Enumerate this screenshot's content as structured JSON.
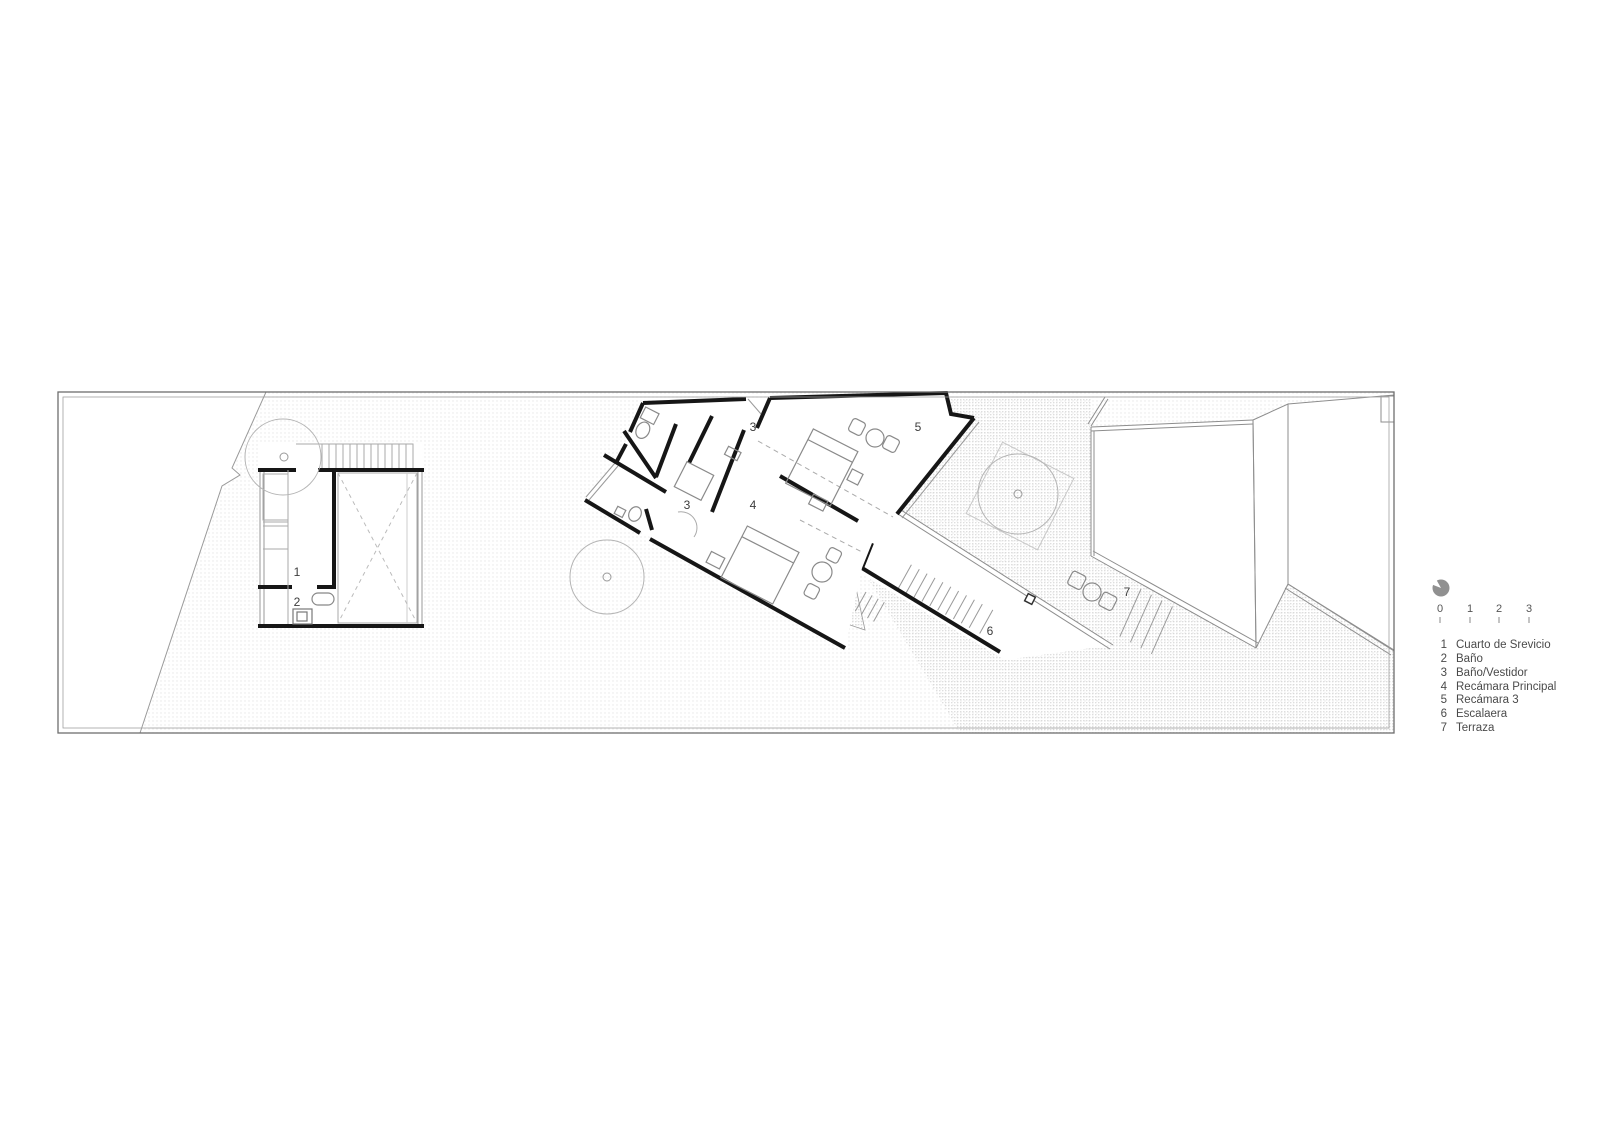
{
  "drawing_type": "architectural-floor-plan",
  "colors": {
    "wall": "#161616",
    "thin_line": "#999999",
    "lighter_line": "#b5b5b5",
    "hatch_light": "#e5e5e5",
    "hatch_dense": "#cbcbcb",
    "text": "#3c3c3c",
    "north_icon": "#909090"
  },
  "plan_labels": {
    "service_room": "1",
    "bathroom": "2",
    "bath_vestidor_top": "3",
    "bath_vestidor_mid": "3",
    "master_bedroom": "4",
    "bedroom3": "5",
    "stair": "6",
    "terrace": "7"
  },
  "scalebar": {
    "ticks": [
      "0",
      "1",
      "2",
      "3"
    ]
  },
  "legend": {
    "items": [
      {
        "num": "1",
        "label": "Cuarto de Srevicio"
      },
      {
        "num": "2",
        "label": "Baño"
      },
      {
        "num": "3",
        "label": "Baño/Vestidor"
      },
      {
        "num": "4",
        "label": "Recámara Principal"
      },
      {
        "num": "5",
        "label": "Recámara 3"
      },
      {
        "num": "6",
        "label": "Escalaera"
      },
      {
        "num": "7",
        "label": "Terraza"
      }
    ]
  }
}
